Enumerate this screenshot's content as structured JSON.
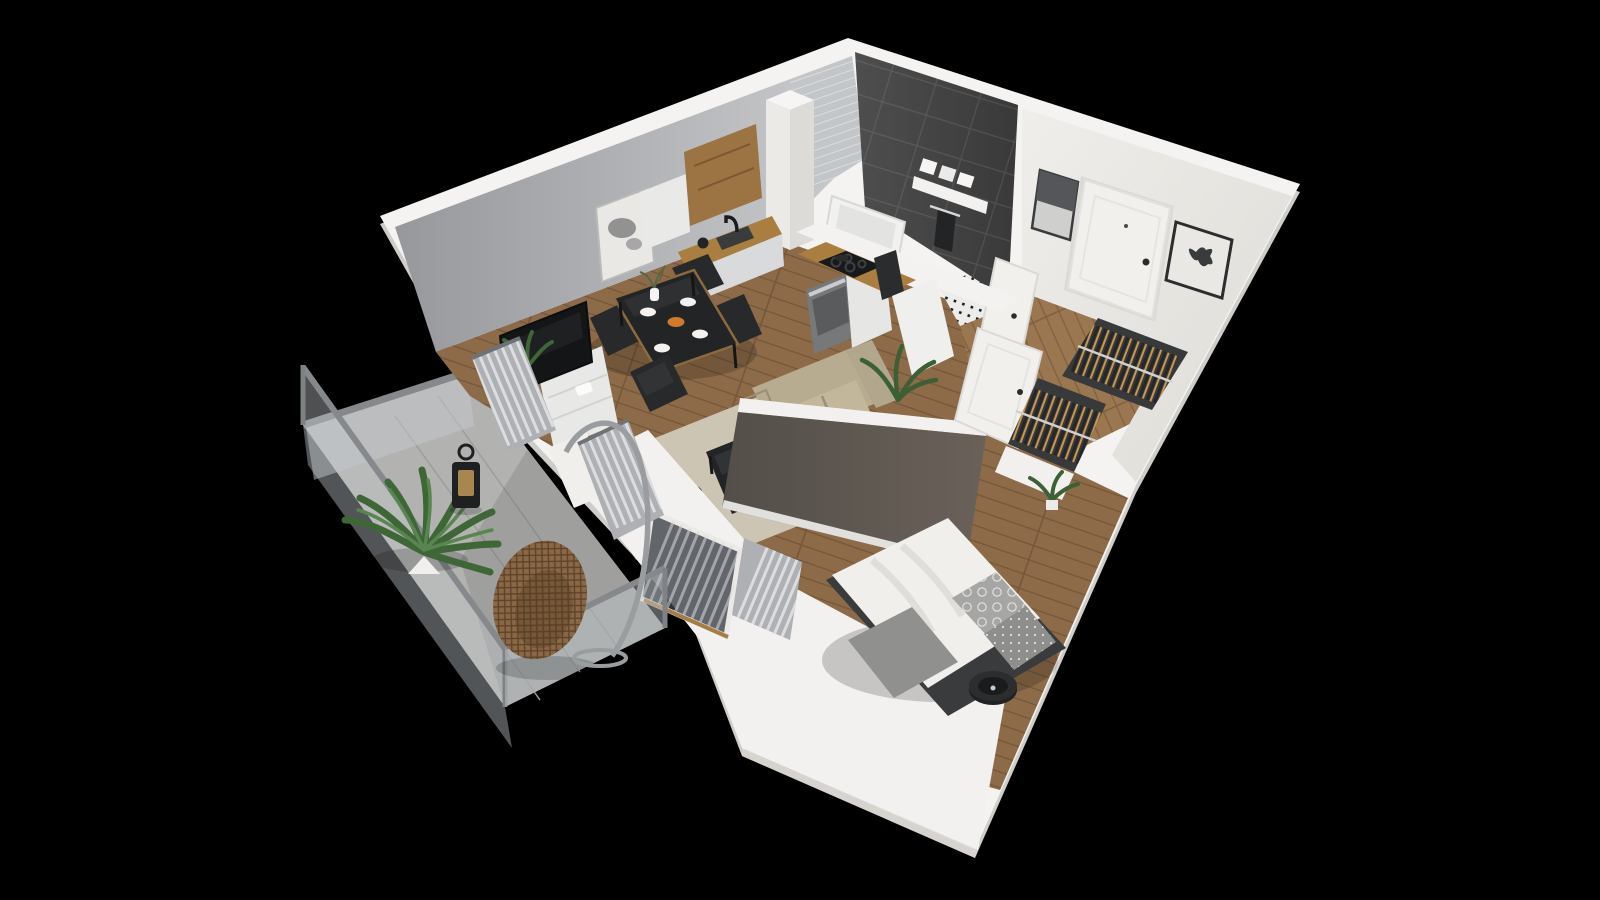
{
  "scene": {
    "type": "3d-apartment-floor-plan-render",
    "view": "isometric-cutaway-top",
    "background": "#000000"
  },
  "palette": {
    "bg": "#000000",
    "wall_top": "#f4f3f1",
    "wall_outer": "#cfcdc9",
    "wall_inner_light": "#efede9",
    "wall_gray_1": "#97989c",
    "wall_gray_2": "#cbccce",
    "partition_1": "#534e49",
    "partition_2": "#6a6159",
    "tile_dark_1": "#4e4e4e",
    "tile_dark_2": "#393939",
    "tile_light": "#c3c6c9",
    "wood_floor": "#8d6b49",
    "wood_floor_2": "#9b7751",
    "wood_counter": "#a97e3f",
    "wood_cabinet": "#9c7342",
    "balcony_floor": "#b2b2b0",
    "concrete_seam": "#9d9d9b",
    "railing": "#85898c",
    "glass": "#c3c8cb",
    "sofa": "#b7ab90",
    "sofa_seat": "#c3b79b",
    "rug": "#ccc5b3",
    "black_furniture": "#232426",
    "chair": "#28292b",
    "tv": "#141517",
    "sideboard": "#e8e8e6",
    "cabinet_white": "#e9e9e8",
    "oven": "#77787a",
    "steel": "#c9cbcd",
    "bed": "#f0efeb",
    "pillow": "#a6a6a4",
    "pillow_dark": "#8e8e8c",
    "blanket": "#90908e",
    "mattress_dark": "#3a3b3d",
    "curtain": "#aeb0b3",
    "curtain_light": "#dcdde0",
    "door": "#f1f0ed",
    "frame_dark": "#2c2d2e",
    "art_bg": "#e9e8e5",
    "closet_bg": "#38393b",
    "hanger_wood": "#c9984f",
    "hanger_dark": "#26272a",
    "rail_steel": "#cfd2d4",
    "plant": "#3f6637",
    "plant_light": "#598550",
    "pot": "#f0efed",
    "rattan": "#8a6845",
    "rattan_dark": "#6f5233",
    "lantern": "#1f2022",
    "towel": "#222426",
    "tub": "#f1f1ef",
    "orange": "#d07a2e",
    "shadow": "rgba(0,0,0,0.18)"
  },
  "rooms": [
    {
      "name": "living-room"
    },
    {
      "name": "kitchen"
    },
    {
      "name": "dining-area"
    },
    {
      "name": "bathroom"
    },
    {
      "name": "entry-hall"
    },
    {
      "name": "wardrobe"
    },
    {
      "name": "bedroom"
    },
    {
      "name": "balcony"
    }
  ],
  "inventory": {
    "dining_chairs": 4,
    "wall_art_frames": 3,
    "wardrobe_rails": 2,
    "plants": 5,
    "sofa_seats": 2,
    "bed_pillows": 3,
    "balcony_items": [
      "fern-plant",
      "lantern",
      "hanging-egg-chair"
    ],
    "kitchen_appliances": [
      "sink",
      "cooktop",
      "oven",
      "coffee-machine"
    ],
    "bathroom_items": [
      "bathtub",
      "shelf-with-towels",
      "hanging-towel"
    ]
  }
}
